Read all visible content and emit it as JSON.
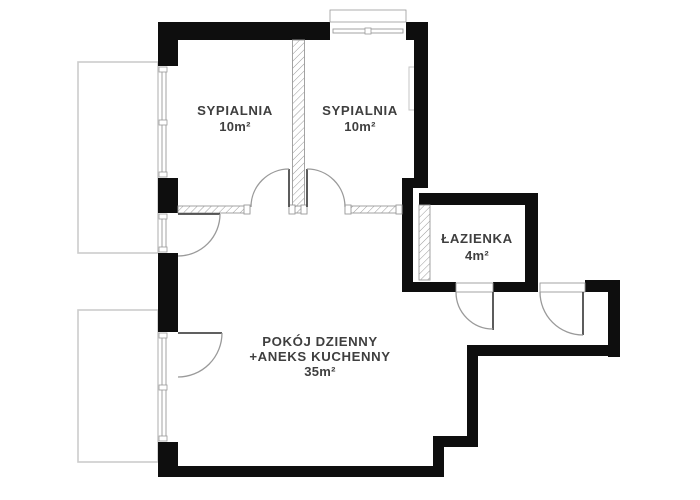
{
  "plan": {
    "rooms": [
      {
        "id": "bedroom-1",
        "name": "SYPIALNIA",
        "area": "10m²"
      },
      {
        "id": "bedroom-2",
        "name": "SYPIALNIA",
        "area": "10m²"
      },
      {
        "id": "bathroom",
        "name": "ŁAZIENKA",
        "area": "4m²"
      },
      {
        "id": "living-room",
        "name_line_1": "POKÓJ DZIENNY",
        "name_line_2": "+ANEKS KUCHENNY",
        "area": "35m²"
      }
    ],
    "colors": {
      "background": "#ffffff",
      "wall": "#0e0e0e",
      "hatch": "#9a9a9a",
      "door_arc": "#9a9a9a",
      "door_leaf": "#4a4a4a",
      "window": "#9a9a9a",
      "balcony_outline": "#cccccc",
      "label_text": "#3f3f3f"
    }
  }
}
